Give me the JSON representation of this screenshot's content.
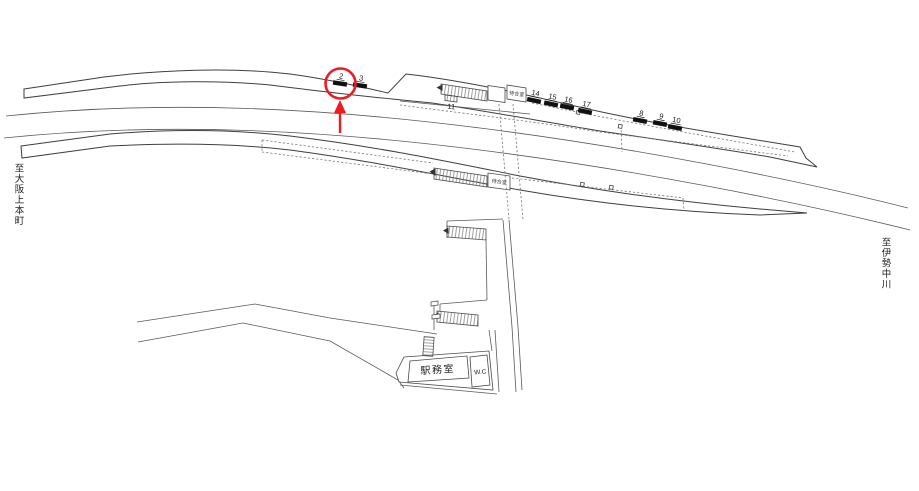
{
  "diagram": {
    "destination_left": "至大阪上本町",
    "destination_right": "至伊勢中川",
    "station_office_label": "駅務室",
    "wc_label": "W.C",
    "waiting_room_upper_label": "待合室",
    "waiting_room_lower_label": "待合室",
    "stairs_position_label": "11",
    "colors": {
      "red": "#ed1c24",
      "line": "#404040",
      "bar": "#111111"
    },
    "markers": [
      {
        "label": "2",
        "x": 340,
        "y": 83.5,
        "angle": 9,
        "circled": true
      },
      {
        "label": "3",
        "x": 360,
        "y": 85.5,
        "angle": 9,
        "circled": false
      },
      {
        "label": "14",
        "x": 534,
        "y": 100.5,
        "angle": 12,
        "circled": false
      },
      {
        "label": "15",
        "x": 551,
        "y": 104,
        "angle": 12,
        "circled": false
      },
      {
        "label": "16",
        "x": 567,
        "y": 107,
        "angle": 12,
        "circled": false
      },
      {
        "label": "17",
        "x": 585,
        "y": 111.5,
        "angle": 12,
        "circled": false
      },
      {
        "label": "8",
        "x": 640,
        "y": 120.5,
        "angle": 11,
        "circled": false
      },
      {
        "label": "9",
        "x": 660,
        "y": 123.5,
        "angle": 11,
        "circled": false
      },
      {
        "label": "10",
        "x": 675,
        "y": 127.5,
        "angle": 11,
        "circled": false
      }
    ],
    "highlight": {
      "circle": {
        "cx": 340.5,
        "cy": 83.5,
        "r": 15
      },
      "arrow": {
        "x": 340,
        "shaft_bottom_y": 133,
        "shaft_top_y": 112,
        "tip_y": 100,
        "half_width": 6
      }
    }
  }
}
